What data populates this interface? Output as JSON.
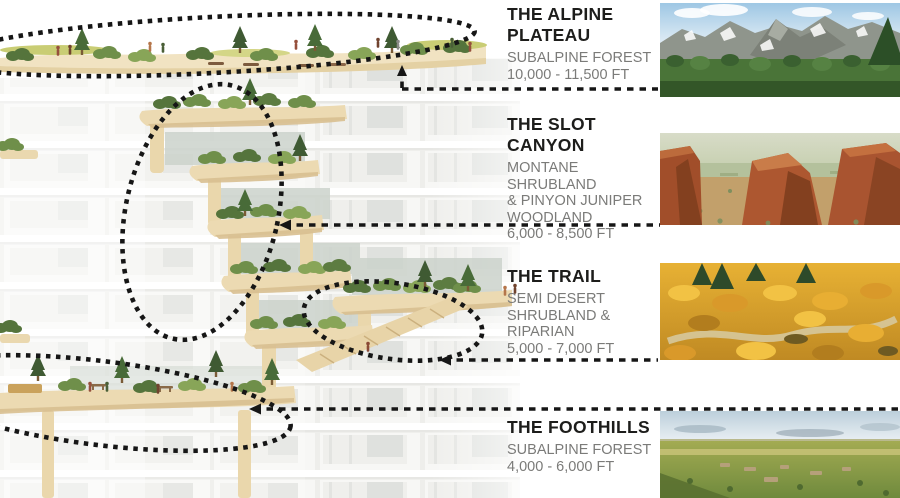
{
  "document": {
    "kind": "architectural-section-diagram",
    "description_note": "Building cross-section render annotated with four Colorado ecosystem zones"
  },
  "colors": {
    "title_text": "#1d1d1b",
    "subtitle_text": "#7b7b79",
    "annotation_ink": "#161616",
    "terrace_tan": "#ecdab2",
    "vegetation_green": "#6f8f4a",
    "background": "#ffffff"
  },
  "sections": [
    {
      "id": "alpine-plateau",
      "title": "THE ALPINE\nPLATEAU",
      "habitat": "SUBALPINE FOREST",
      "elevation": "10,000 - 11,500 FT",
      "photo": "alpine-mountains-photo",
      "annotation": "dashed arrow pointing up to rooftop plateau, dashed ellipse around roof deck"
    },
    {
      "id": "slot-canyon",
      "title": "THE SLOT\nCANYON",
      "habitat": "MONTANE SHRUBLAND\n& PINYON JUNIPER\nWOODLAND",
      "elevation": "6,000 - 8,500 FT",
      "photo": "red-rock-canyon-photo",
      "annotation": "dashed arrow pointing left to terraced canyon cascade, tall dashed ellipse"
    },
    {
      "id": "trail",
      "title": "THE TRAIL",
      "habitat": "SEMI DESERT\nSHRUBLAND &\nRIPARIAN",
      "elevation": "5,000 - 7,000 FT",
      "photo": "golden-shrubland-photo",
      "annotation": "dashed arrow pointing left to stair trail, dashed ellipse around trail"
    },
    {
      "id": "foothills",
      "title": "THE FOOTHILLS",
      "habitat": "SUBALPINE FOREST",
      "elevation": "4,000 - 6,000 FT",
      "photo": "grassland-plains-photo",
      "annotation": "dashed arrow pointing left to lower garden terrace, dashed sweep around terrace"
    }
  ]
}
